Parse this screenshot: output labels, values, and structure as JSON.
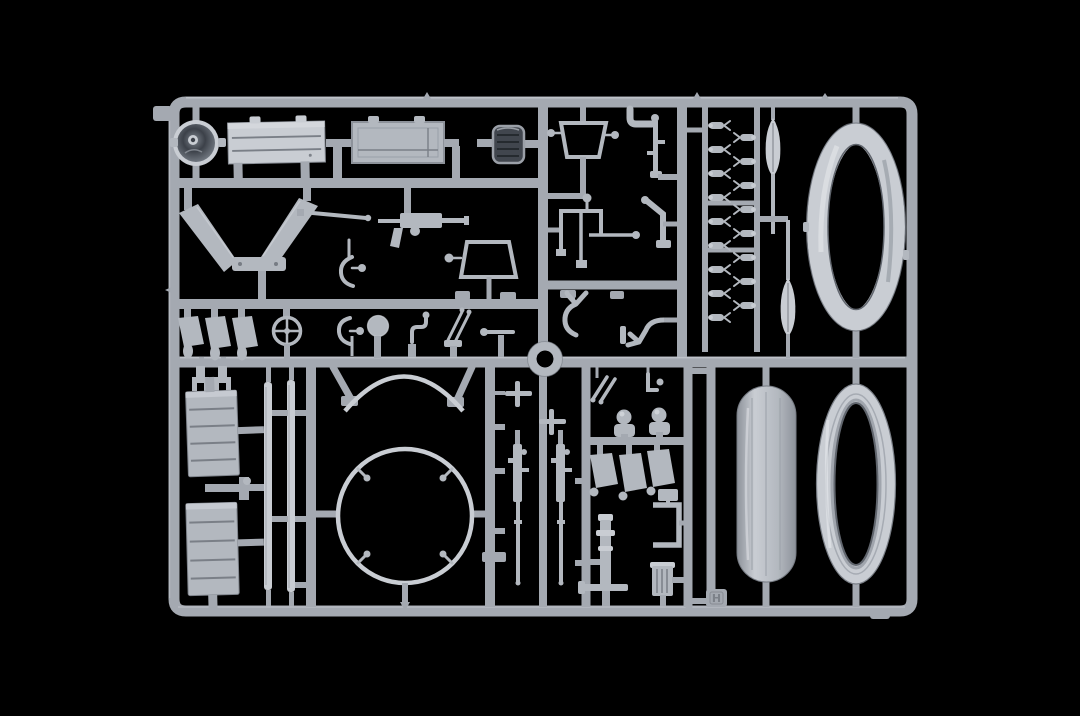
{
  "scene": {
    "type": "product photo",
    "subject": "plastic model kit sprue (injection-molded parts tree)",
    "background": "black",
    "plastic_finish": "light grey styrene",
    "sprue_letter": "H"
  },
  "colors": {
    "bg": "#000000",
    "bar": "#a4a9b1",
    "bar_hl": "#d3d7dc",
    "plastic": "#b3b8bf",
    "plastic_light": "#c9cdd3",
    "plastic_dark": "#8d929a",
    "line_dark": "#7a7f87",
    "grille": "#41464e",
    "grille_rim": "#9ba0a8",
    "drum_face": "#3c4149",
    "drum_edge": "#7b828b",
    "hole_rim": "#60656d",
    "tag_letter": "#7c8189"
  }
}
